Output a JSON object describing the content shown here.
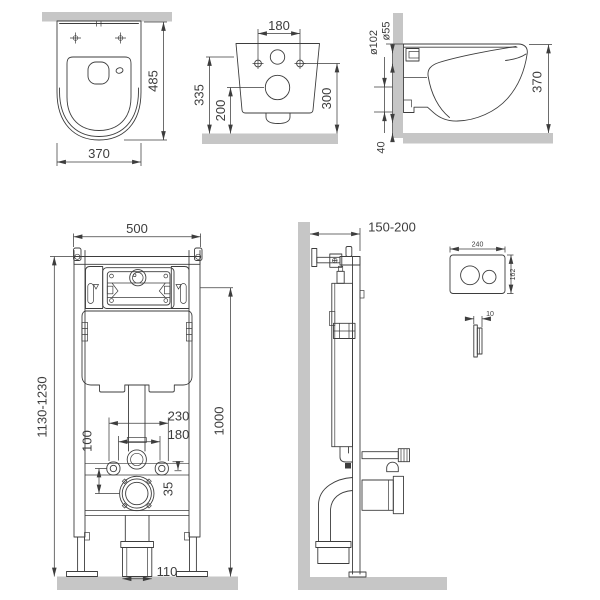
{
  "colors": {
    "line": "#3d3d3d",
    "masonry": "#c6c6c6",
    "background": "#ffffff"
  },
  "views": {
    "toilet_top": {
      "depth": "485",
      "width": "370"
    },
    "toilet_back": {
      "bolt_spacing": "180",
      "inlet_height": "335",
      "outlet_height": "200",
      "bolt_height": "300"
    },
    "toilet_side": {
      "inlet_diameter": "ø55",
      "outlet_diameter": "ø102",
      "height": "370",
      "floor_gap": "40"
    },
    "frame_front": {
      "width": "500",
      "install_height": "1130-1230",
      "rod_spacing": "230",
      "pipe_spacing": "180",
      "outlet_drop": "100",
      "reference_height": "1000",
      "offset": "35",
      "drain_width": "110"
    },
    "frame_side": {
      "wall_distance": "150-200"
    },
    "flush_plate": {
      "width": "240",
      "height": "162",
      "thickness": "10"
    }
  }
}
